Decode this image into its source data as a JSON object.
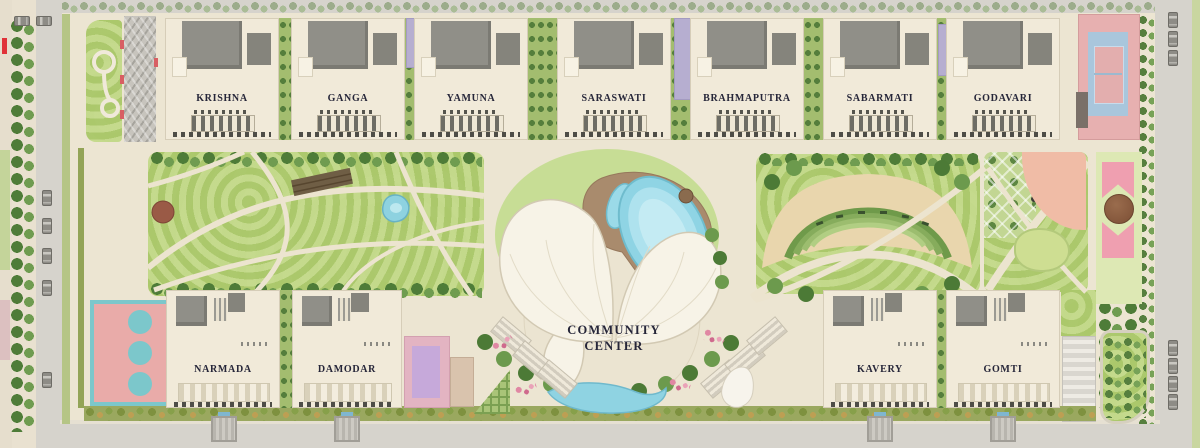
{
  "plan": {
    "type": "residential-site-master-plan",
    "community_center": {
      "label_line1": "COMMUNITY",
      "label_line2": "CENTER"
    },
    "towers_top": [
      {
        "name": "KRISHNA"
      },
      {
        "name": "GANGA"
      },
      {
        "name": "YAMUNA"
      },
      {
        "name": "SARASWATI"
      },
      {
        "name": "BRAHMAPUTRA"
      },
      {
        "name": "SABARMATI"
      },
      {
        "name": "GODAVARI"
      }
    ],
    "towers_bottom": [
      {
        "name": "NARMADA"
      },
      {
        "name": "DAMODAR"
      },
      {
        "name": "KAVERY"
      },
      {
        "name": "GOMTI"
      }
    ]
  },
  "colors": {
    "ground_path": "#ece5d2",
    "lawn": "#bcd380",
    "tree_dark": "#4e7c38",
    "tree_light": "#6f9c50",
    "water": "#8fd4e4",
    "pool_deck": "#a98b6d",
    "building_cream": "#f1ead9",
    "roof_gray": "#908f88",
    "label_ink": "#262639",
    "road_gray": "#d6d3cc",
    "hedge_green": "#9aa85f",
    "court_pink": "#e7b0b0",
    "tennis_blue": "#a9c6dc",
    "basketball_pink": "#e9aba9",
    "basketball_teal": "#7cc7cb",
    "flower_pink": "#ef9fb0",
    "lavender_block": "#b6aed0",
    "red_marker": "#e03238"
  }
}
